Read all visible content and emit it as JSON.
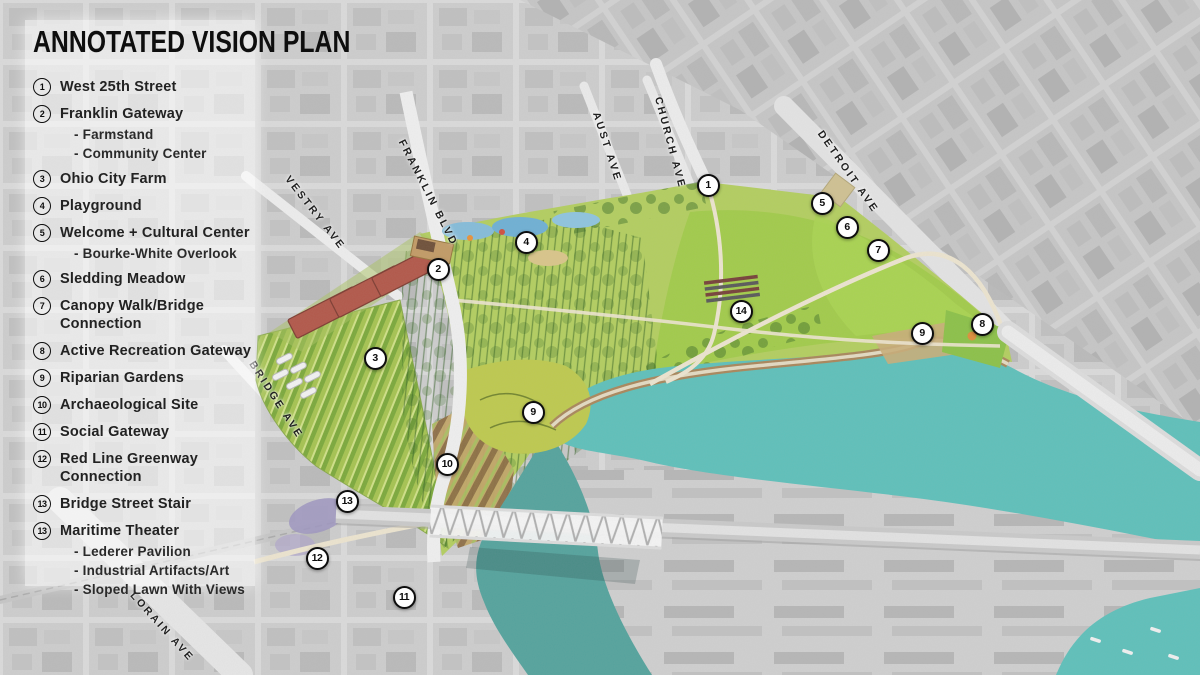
{
  "title": "ANNOTATED VISION PLAN",
  "legend": {
    "sub_prefix": "- ",
    "items": [
      {
        "num": "1",
        "label": "West 25th Street",
        "subs": []
      },
      {
        "num": "2",
        "label": "Franklin Gateway",
        "subs": [
          "Farmstand",
          "Community Center"
        ]
      },
      {
        "num": "3",
        "label": "Ohio City Farm",
        "subs": []
      },
      {
        "num": "4",
        "label": "Playground",
        "subs": []
      },
      {
        "num": "5",
        "label": "Welcome + Cultural Center",
        "subs": [
          "Bourke-White Overlook"
        ]
      },
      {
        "num": "6",
        "label": "Sledding Meadow",
        "subs": []
      },
      {
        "num": "7",
        "label": "Canopy Walk/Bridge Connection",
        "subs": []
      },
      {
        "num": "8",
        "label": "Active Recreation Gateway",
        "subs": []
      },
      {
        "num": "9",
        "label": "Riparian Gardens",
        "subs": []
      },
      {
        "num": "10",
        "label": "Archaeological Site",
        "subs": []
      },
      {
        "num": "11",
        "label": "Social Gateway",
        "subs": []
      },
      {
        "num": "12",
        "label": "Red Line Greenway Connection",
        "subs": []
      },
      {
        "num": "13",
        "label": "Bridge Street Stair",
        "subs": []
      },
      {
        "num": "13",
        "label": "Maritime Theater",
        "subs": [
          "Lederer Pavilion",
          "Industrial Artifacts/Art",
          "Sloped Lawn With Views"
        ]
      }
    ]
  },
  "map": {
    "markers": [
      {
        "num": "1",
        "x": 708,
        "y": 185
      },
      {
        "num": "2",
        "x": 438,
        "y": 269
      },
      {
        "num": "3",
        "x": 375,
        "y": 358
      },
      {
        "num": "4",
        "x": 526,
        "y": 242
      },
      {
        "num": "5",
        "x": 822,
        "y": 203
      },
      {
        "num": "6",
        "x": 847,
        "y": 227
      },
      {
        "num": "7",
        "x": 878,
        "y": 250
      },
      {
        "num": "8",
        "x": 982,
        "y": 324
      },
      {
        "num": "9",
        "x": 922,
        "y": 333
      },
      {
        "num": "9",
        "x": 533,
        "y": 412
      },
      {
        "num": "10",
        "x": 447,
        "y": 464
      },
      {
        "num": "11",
        "x": 404,
        "y": 597
      },
      {
        "num": "12",
        "x": 317,
        "y": 558
      },
      {
        "num": "13",
        "x": 347,
        "y": 501
      },
      {
        "num": "14",
        "x": 741,
        "y": 311
      }
    ],
    "street_labels": [
      {
        "name": "VESTRY AVE",
        "x": 315,
        "y": 213,
        "angle": 52
      },
      {
        "name": "FRANKLIN BLVD",
        "x": 428,
        "y": 193,
        "angle": 63
      },
      {
        "name": "AUST AVE",
        "x": 607,
        "y": 147,
        "angle": 72
      },
      {
        "name": "CHURCH AVE",
        "x": 670,
        "y": 143,
        "angle": 75
      },
      {
        "name": "DETROIT AVE",
        "x": 848,
        "y": 172,
        "angle": 55
      },
      {
        "name": "BRIDGE AVE",
        "x": 276,
        "y": 400,
        "angle": 57
      },
      {
        "name": "LORAIN AVE",
        "x": 162,
        "y": 627,
        "angle": 48
      }
    ]
  },
  "colors": {
    "river": "#5fc0ba",
    "river_channel": "#55a39d",
    "park_base": "#b3ce60",
    "lawn": "#a2cb4b",
    "tree_dark": "#3a6a26",
    "farm_row": "#7ca93c",
    "aerial_gray": "#d6d6d6",
    "brick_building": "#b2584a",
    "marker_border": "#0d0d0d"
  }
}
